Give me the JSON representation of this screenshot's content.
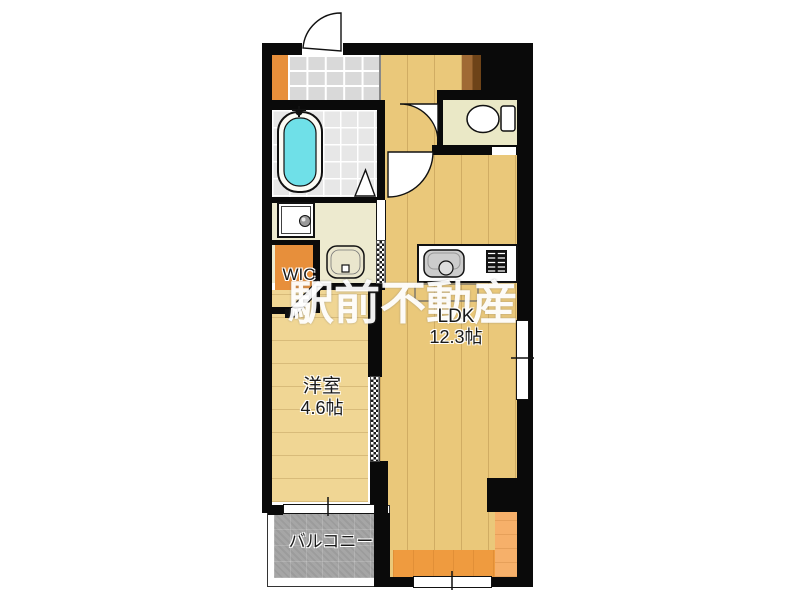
{
  "floorplan": {
    "watermark": "駅前不動産",
    "rooms": {
      "ldk": {
        "label": "LDK",
        "area": "12.3帖"
      },
      "western_room": {
        "label": "洋室",
        "area": "4.6帖"
      },
      "wic": {
        "label": "WIC"
      },
      "balcony": {
        "label": "バルコニー"
      }
    },
    "fixtures": {
      "bathtub": "bathtub-icon",
      "bath_faucet": "faucet-icon",
      "washing_machine_pan": "washing-machine-pan-icon",
      "vanity_basin": "vanity-basin-icon",
      "toilet": "toilet-icon",
      "kitchen_sink": "kitchen-sink-icon",
      "stove": "stove-icon",
      "entrance_door": "swing-door-icon",
      "toilet_door": "swing-door-icon",
      "ldk_door": "swing-door-icon",
      "wic_door": "hinged-door-icon",
      "bath_folding_door": "folding-door-triangle-icon",
      "sliding_doors": "sliding-door-dotted-icon"
    },
    "colors": {
      "wall": "#0a0a0a",
      "wood_ldk": "#eac87a",
      "wood_western": "#f0d694",
      "entry_tile": "#d9d9d9",
      "bath_tile": "#e7e7e7",
      "tub_water": "#6fe0e8",
      "washroom_floor": "#edeacf",
      "toilet_floor": "#eae8c6",
      "wic_orange": "#e78f3b",
      "accent_orange": "#ef9b3f",
      "accent_orange_light": "#f6b06a",
      "balcony_gray": "#a6a6a6",
      "storage_brown": "#8a5a28"
    }
  }
}
